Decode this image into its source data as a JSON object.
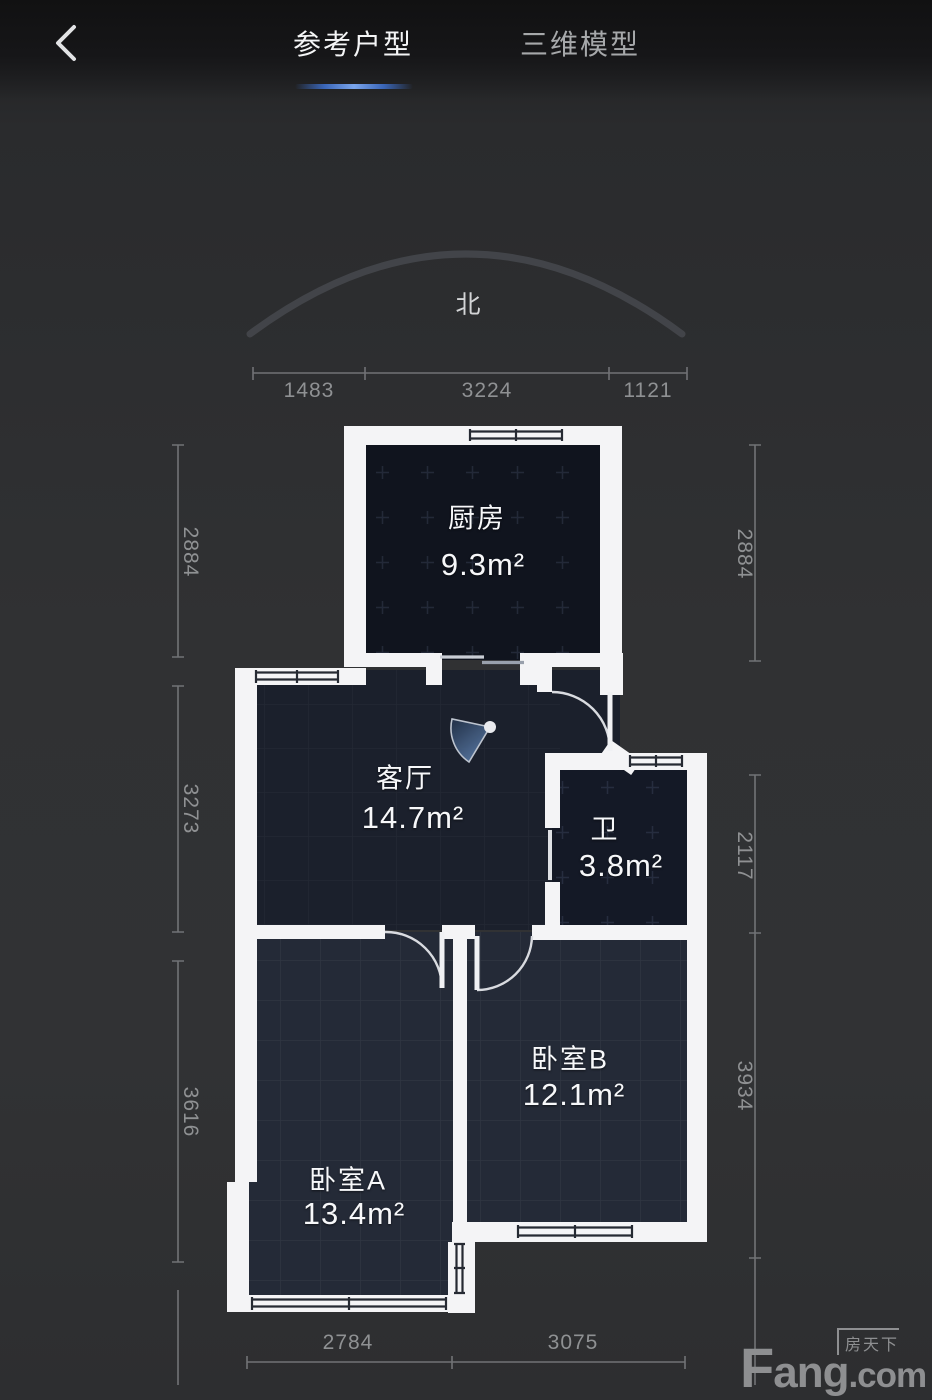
{
  "header": {
    "back_icon": "chevron-left",
    "tabs": [
      {
        "label": "参考户型",
        "active": true
      },
      {
        "label": "三维模型",
        "active": false
      }
    ]
  },
  "compass": {
    "north": "北"
  },
  "rooms": {
    "kitchen": {
      "name": "厨房",
      "area": "9.3m²"
    },
    "living": {
      "name": "客厅",
      "area": "14.7m²"
    },
    "bath": {
      "name": "卫",
      "area": "3.8m²"
    },
    "bedroomA": {
      "name": "卧室A",
      "area": "13.4m²"
    },
    "bedroomB": {
      "name": "卧室B",
      "area": "12.1m²"
    }
  },
  "dimensions": {
    "top": [
      "1483",
      "3224",
      "1121"
    ],
    "left": [
      "2884",
      "3273",
      "3616"
    ],
    "right": [
      "2884",
      "2117",
      "3934"
    ],
    "bottom": [
      "2784",
      "3075"
    ]
  },
  "watermark": {
    "brand_cn": "房天下",
    "brand_f": "F",
    "brand_ang": "ang",
    "brand_com": ".com"
  },
  "colors": {
    "tab_indicator": "#4d86e0",
    "wall": "#f4f4f6",
    "background": "#2e2f31",
    "room_fill_dark": "#10141e",
    "room_fill_light": "#242a37",
    "door_fan_dark": "#223148",
    "door_fan_light": "#5a7aa6",
    "dim_text": "#8f9193"
  }
}
